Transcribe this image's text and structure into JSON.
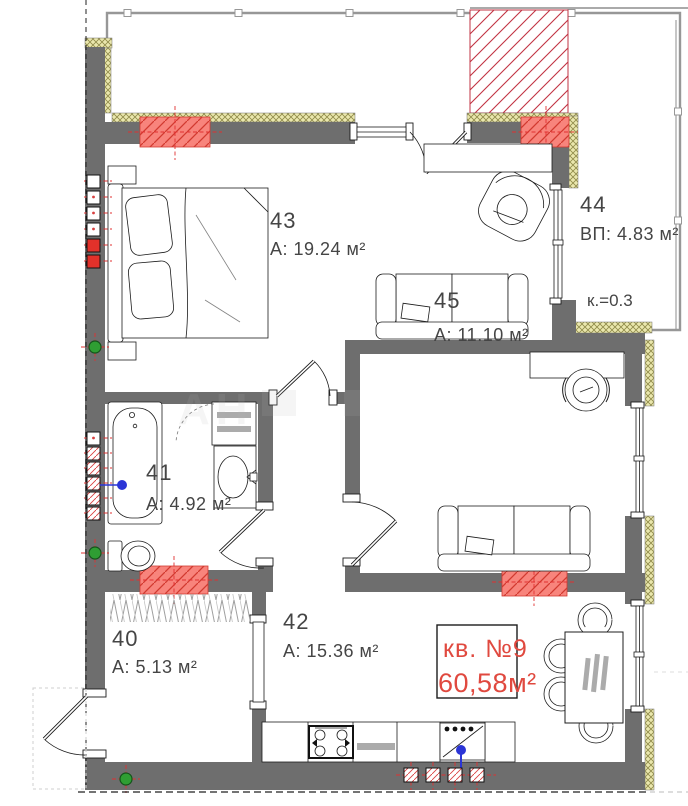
{
  "plan_title": "apartment floor plan",
  "apartment": {
    "number_label": "кв. №9",
    "total_area_label": "60,58м²"
  },
  "rooms": [
    {
      "key": "43",
      "number": "43",
      "area": "A: 19.24 м²"
    },
    {
      "key": "44",
      "number": "44",
      "area": "ВП: 4.83 м²",
      "coefficient": "к.=0.3"
    },
    {
      "key": "45",
      "number": "45",
      "area": "A: 11.10 м²"
    },
    {
      "key": "41",
      "number": "41",
      "area": "A: 4.92 м²"
    },
    {
      "key": "40",
      "number": "40",
      "area": "A: 5.13 м²"
    },
    {
      "key": "42",
      "number": "42",
      "area": "A: 15.36 м²"
    }
  ],
  "watermark": "АН",
  "colors": {
    "wall": "#6e6e6e",
    "insulation_fill": "#eae7ad",
    "insulation_line": "#8f8a49",
    "vent_fill": "#f8847c",
    "vent_line": "#d23a30",
    "shaft_line": "#c23343",
    "accent_red": "#e0493f",
    "marker_green": "#2f9e33",
    "plumbing_blue": "#2b35d6"
  }
}
